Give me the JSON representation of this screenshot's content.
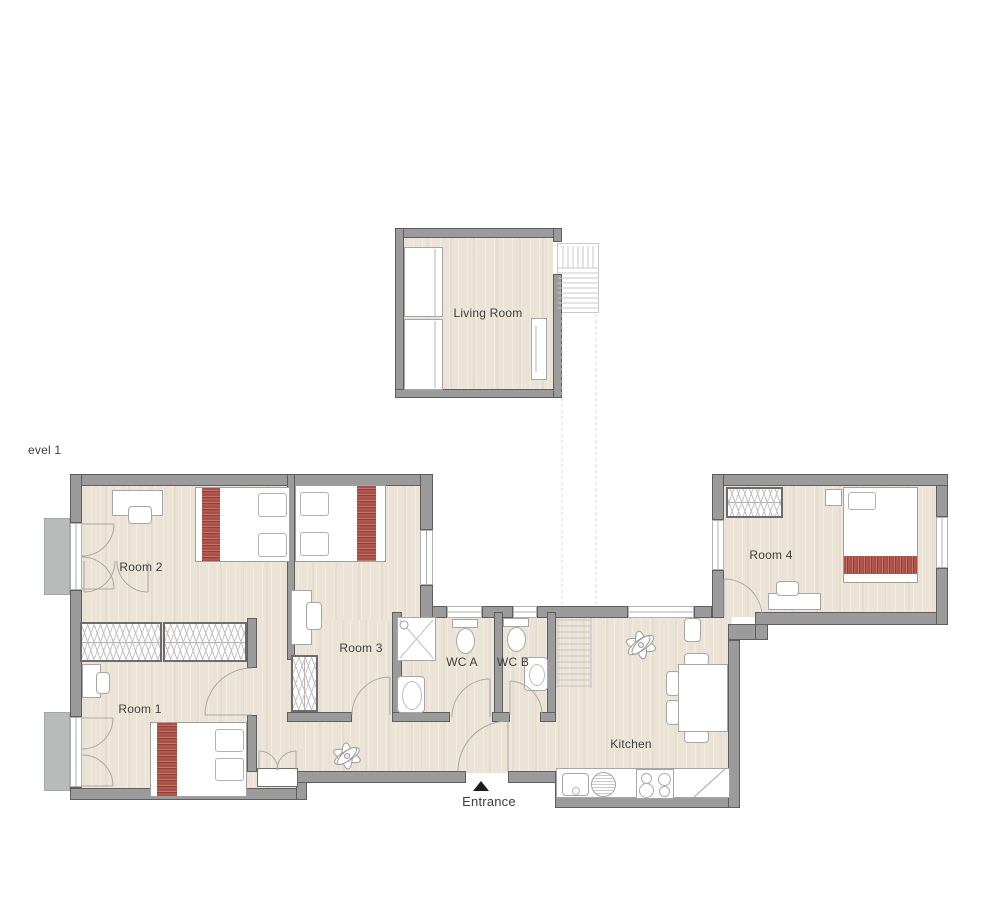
{
  "floor_plan": {
    "level_label": "evel 1",
    "labels": {
      "living_room": "Living Room",
      "room1": "Room 1",
      "room2": "Room 2",
      "room3": "Room 3",
      "room4": "Room 4",
      "wc_a": "WC A",
      "wc_b": "WC B",
      "kitchen": "Kitchen",
      "entrance": "Entrance"
    },
    "entrance_marker": "triangle-up",
    "colors": {
      "wall": "#9b9b9b",
      "wall_edge": "#5e5e5e",
      "floor": "#ebe4d6",
      "balcony": "#b7bcba",
      "blanket_red": "#b0574e",
      "blanket_red_dark": "#8e3f3a",
      "fixture_stroke": "#a6a6a6",
      "stair_line": "#c4c4c4",
      "label_text": "#3d3d3d"
    },
    "fixtures": [
      "bed",
      "pillow",
      "wardrobe",
      "closet",
      "desk",
      "chair",
      "sofa",
      "tv-unit",
      "toilet",
      "shower",
      "bathtub",
      "sink",
      "kitchen-counter",
      "stove",
      "dining-table",
      "plant",
      "stairs",
      "balcony",
      "window",
      "door-swing",
      "entrance-marker"
    ]
  }
}
